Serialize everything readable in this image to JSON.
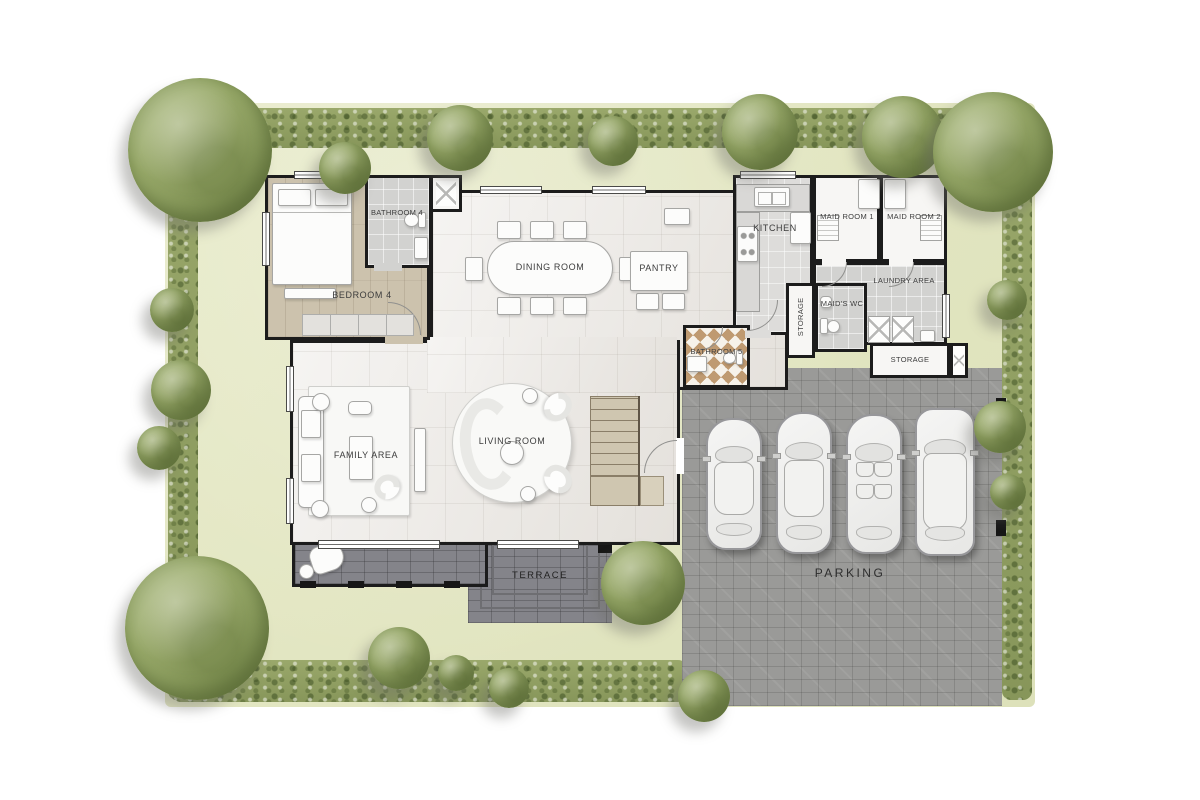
{
  "plan": {
    "type": "floor-plan",
    "rooms": {
      "bedroom4": {
        "label": "BEDROOM 4"
      },
      "bathroom4": {
        "label": "BATHROOM 4"
      },
      "dining": {
        "label": "DINING ROOM"
      },
      "pantry": {
        "label": "PANTRY"
      },
      "kitchen": {
        "label": "KITCHEN"
      },
      "maid1": {
        "label": "MAID ROOM 1"
      },
      "maid2": {
        "label": "MAID ROOM 2"
      },
      "laundry": {
        "label": "LAUNDRY AREA"
      },
      "storage_hall": {
        "label": "STORAGE"
      },
      "maids_wc": {
        "label": "MAID'S WC"
      },
      "storage_garage": {
        "label": "STORAGE"
      },
      "bathroom5": {
        "label": "BATHROOM 5"
      },
      "family": {
        "label": "FAMILY AREA"
      },
      "living": {
        "label": "LIVING ROOM"
      },
      "terrace": {
        "label": "TERRACE"
      },
      "parking": {
        "label": "PARKING"
      }
    },
    "counts": {
      "parked_cars": 4,
      "dining_chairs": 8,
      "washing_machines": 2
    },
    "colors": {
      "lawn": "#e2e6c2",
      "hedge": "#90a062",
      "tree": "#a4b377",
      "wall": "#1c1c1c",
      "floor_marble": "#ece9e5",
      "floor_wood": "#ccc2ad",
      "floor_tile": "#d2d2d0",
      "bath5_tile": "#bf9a71",
      "parking_pavers": "#9a9a98",
      "terrace_pavers": "#84848a",
      "stairs": "#cfc6b0",
      "background": "#ffffff"
    }
  }
}
